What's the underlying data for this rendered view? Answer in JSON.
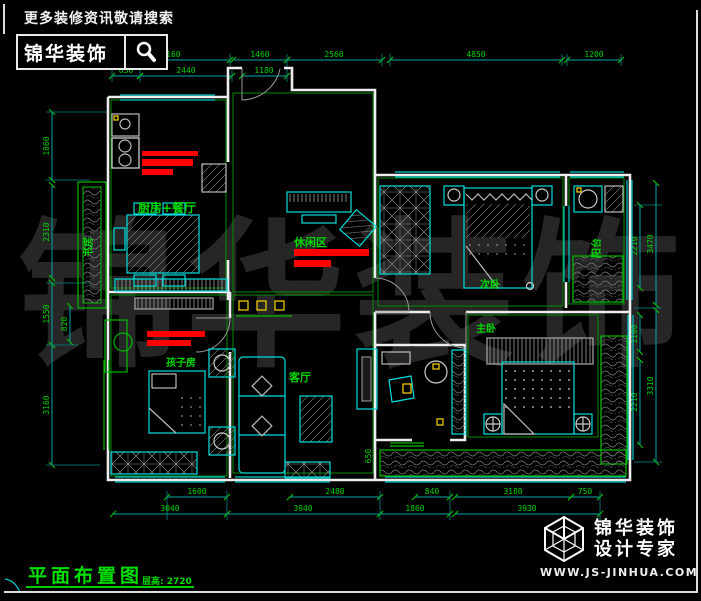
{
  "colors": {
    "background": "#000000",
    "wall": "#ededed",
    "line_cyan": "#00c8c8",
    "line_green": "#009900",
    "dim_text_green": "#00d200",
    "red_mark": "#ff0000",
    "yellow_accent": "#ffd700",
    "watermark_gray": "#262626"
  },
  "header": {
    "slogan": "更多装修资讯敬请搜索",
    "logo_text": "锦华装饰"
  },
  "watermark": {
    "text": "锦华装饰"
  },
  "rooms": {
    "kitchen_dining": "厨房+餐厅",
    "study": "书房",
    "kids_room": "孩子房",
    "leisure_area": "休闲区",
    "living_room": "客厅",
    "second_bedroom": "次卧",
    "master_bedroom": "主卧",
    "balcony": "阳台"
  },
  "dims": {
    "top_outer": [
      "3160",
      "1460",
      "2560",
      "4850",
      "1200"
    ],
    "top_inner": [
      "630",
      "2440",
      "1180"
    ],
    "left_outer": [
      "1860",
      "2310",
      "1550",
      "3160"
    ],
    "left_inner": [
      "820"
    ],
    "right_inner": [
      "2210",
      "1100",
      "2210"
    ],
    "right_outer": [
      "3470",
      "3310"
    ],
    "bottom_inner": [
      "1600",
      "2480",
      "840",
      "3180",
      "750"
    ],
    "bottom_outer": [
      "3040",
      "3940",
      "1860",
      "3930"
    ],
    "misc": [
      "650"
    ]
  },
  "footer": {
    "title": "平面布置图",
    "floor_height": "层高: 2720"
  },
  "brand": {
    "name": "锦华装饰",
    "tagline": "设计专家",
    "website": "WWW.JS-JINHUA.COM"
  }
}
